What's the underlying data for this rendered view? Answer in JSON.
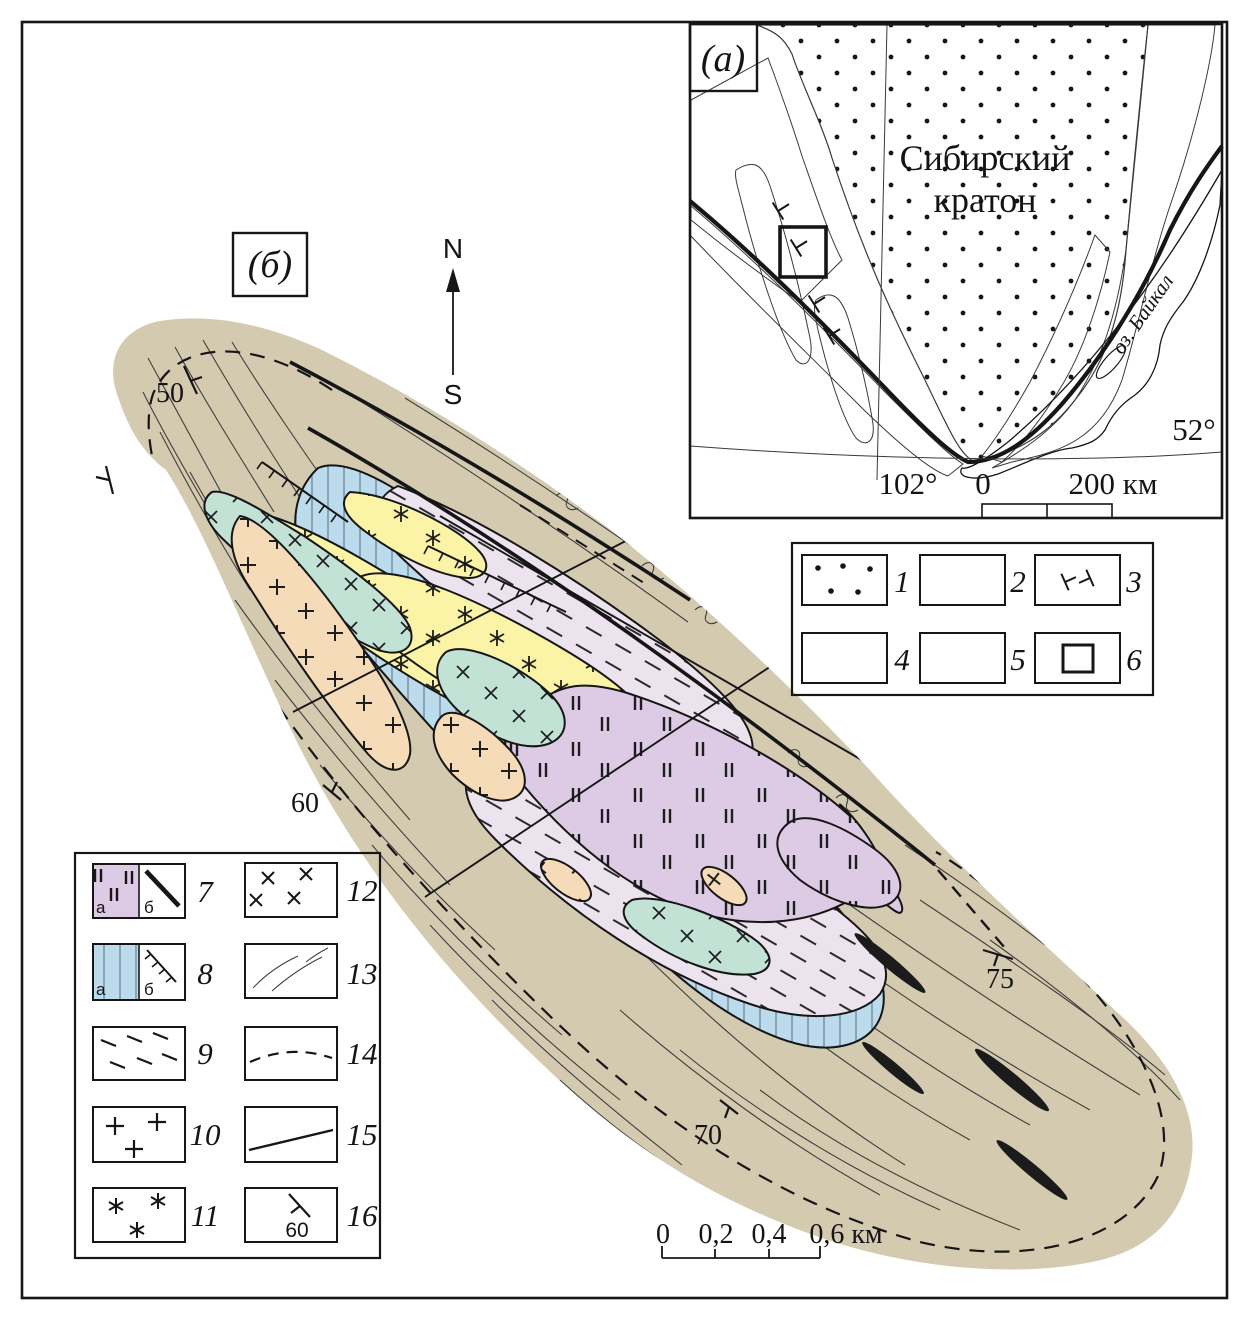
{
  "figure": {
    "colors": {
      "tan": "#d3cab0",
      "blue": "#bcdcee",
      "lavender": "#ece3ee",
      "pink": "#ddcbe5",
      "yellow": "#fbf3a5",
      "green": "#c2e2d6",
      "peach": "#f5dbb8",
      "gray_band": "#b9b9b9",
      "light_gray": "#f0efed",
      "lens_black": "#1b1b1b",
      "line": "#161616"
    },
    "panel_a": {
      "label": "(а)",
      "craton_name_line1": "Сибирский",
      "craton_name_line2": "кратон",
      "lake_label": "оз. Байкал",
      "latitude_label": "52°",
      "longitude_label": "102°",
      "scale_zero": "0",
      "scale_end": "200 км"
    },
    "legend_a": {
      "items": [
        {
          "num": "1"
        },
        {
          "num": "2"
        },
        {
          "num": "3"
        },
        {
          "num": "4"
        },
        {
          "num": "5"
        },
        {
          "num": "6"
        }
      ]
    },
    "panel_b": {
      "label": "(б)",
      "compass_north": "N",
      "compass_south": "S",
      "dip_values": [
        "50",
        "60",
        "70",
        "75"
      ],
      "scale_ticks": [
        "0",
        "0,2",
        "0,4",
        "0,6 км"
      ]
    },
    "legend_b": {
      "items": [
        {
          "num": "7",
          "sub_a": "а",
          "sub_b": "б"
        },
        {
          "num": "8",
          "sub_a": "а",
          "sub_b": "б"
        },
        {
          "num": "9"
        },
        {
          "num": "10"
        },
        {
          "num": "11"
        },
        {
          "num": "12"
        },
        {
          "num": "13"
        },
        {
          "num": "14"
        },
        {
          "num": "15"
        },
        {
          "num": "16",
          "dip_value": "60"
        }
      ]
    }
  }
}
